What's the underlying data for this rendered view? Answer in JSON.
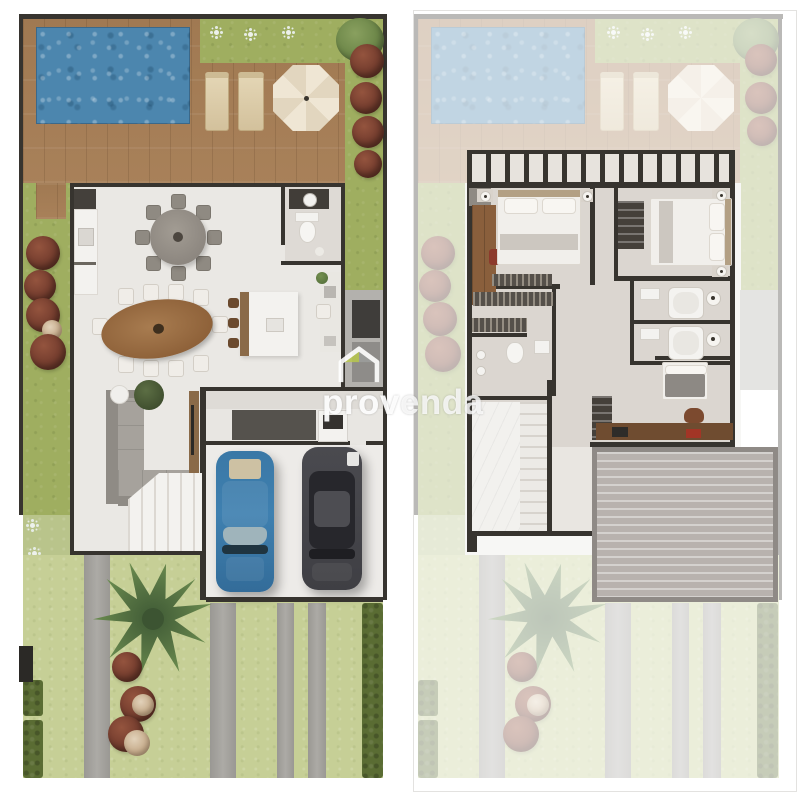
{
  "document": {
    "type": "real-estate-floorplan-collage",
    "panel_count": 2,
    "background": "#ffffff"
  },
  "watermark": {
    "brand_prefix": "prov",
    "brand_suffix": "enda",
    "brand_full": "provenda",
    "icon": "house-logo-icon",
    "icon_roof_color": "#b9c84e",
    "text_color": "#ffffff"
  },
  "panels": {
    "left": {
      "name": "ground-floor-site-plan",
      "rooms": [
        "pool-deck",
        "swimming-pool",
        "gourmet-area",
        "kitchen",
        "dining-room",
        "lavatory",
        "living-room",
        "laundry",
        "garage",
        "front-yard"
      ],
      "features": [
        "swimming-pool",
        "wood-deck",
        "2-sun-loungers",
        "parasol",
        "round-table-8-chairs",
        "oval-dining-table-10-chairs",
        "bar-island-3-stools",
        "l-shaped-sofa",
        "tv-panel",
        "staircase",
        "washer",
        "blue-car",
        "gray-car",
        "palm-tree",
        "driveway-strips",
        "garden-shrubs",
        "hedges"
      ]
    },
    "right": {
      "name": "upper-floor-plan",
      "rooms": [
        "balcony",
        "master-bedroom",
        "bedroom-2",
        "bedroom-3-office",
        "bathroom-1",
        "bathroom-2",
        "ensuite-bathroom",
        "walk-in-closet",
        "hallway",
        "stair-void"
      ],
      "features": [
        "balcony-railing",
        "double-bed",
        "wardrobe",
        "closet-shelves",
        "clothes-racks",
        "bathtubs",
        "desk-with-chair",
        "single-bed",
        "garage-roof",
        "faded-ground-floor-background"
      ]
    }
  },
  "palette": {
    "wall": "#37342f",
    "pool_water": "#4c86ae",
    "deck_wood": "#a8815a",
    "grass": "#9fae60",
    "front_lawn": "#c6cf96",
    "hedge": "#5a6c33",
    "shrub": "#7a4131",
    "palm": "#567343",
    "interior_floor": "#eae8e4",
    "upper_floor": "#dbd6d0",
    "dining_table_wood": "#9b6e45",
    "furniture_wood": "#8a6a48",
    "counter_dark": "#44403b",
    "sofa_gray": "#a6a29c",
    "car_blue": "#3e7dab",
    "car_gray": "#48484d",
    "roof_gray": "#b8b2ae",
    "umbrella": "#efe6d4",
    "sun_lounger": "#d9c9a8",
    "driveway": "#a7a5a0"
  }
}
